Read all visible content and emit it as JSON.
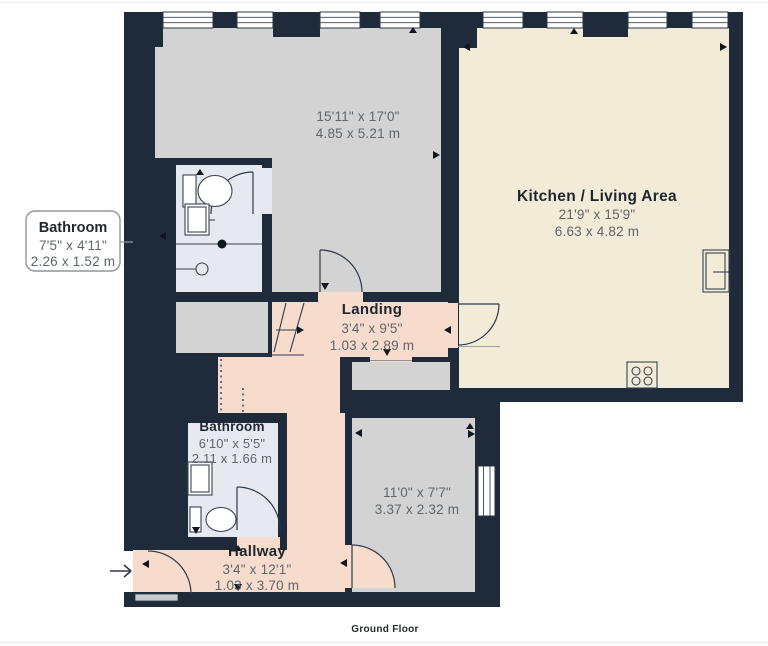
{
  "floor_plan": {
    "title": "Ground Floor",
    "colors": {
      "wall": "#1f2b3a",
      "room_gray": "#d2d3d2",
      "kitchen_cream": "#f1ebd8",
      "hall_salmon": "#f7dcce",
      "bathroom_blue": "#e6eaf0"
    },
    "callout": {
      "title": "Bathroom",
      "imperial": "7'5\" x 4'11\"",
      "metric": "2.26 x 1.52 m"
    },
    "rooms": {
      "bedroom_main": {
        "imperial": "15'11\" x 17'0\"",
        "metric": "4.85 x 5.21 m"
      },
      "kitchen_living": {
        "title": "Kitchen / Living Area",
        "imperial": "21'9\" x 15'9\"",
        "metric": "6.63 x 4.82 m"
      },
      "landing": {
        "title": "Landing",
        "imperial": "3'4\" x 9'5\"",
        "metric": "1.03 x 2.89 m"
      },
      "bathroom_lower": {
        "title": "Bathroom",
        "imperial": "6'10\" x 5'5\"",
        "metric": "2.11 x 1.66 m"
      },
      "bedroom_small": {
        "imperial": "11'0\" x 7'7\"",
        "metric": "3.37 x 2.32 m"
      },
      "hallway": {
        "title": "Hallway",
        "imperial": "3'4\" x 12'1\"",
        "metric": "1.03 x 3.70 m"
      }
    }
  }
}
